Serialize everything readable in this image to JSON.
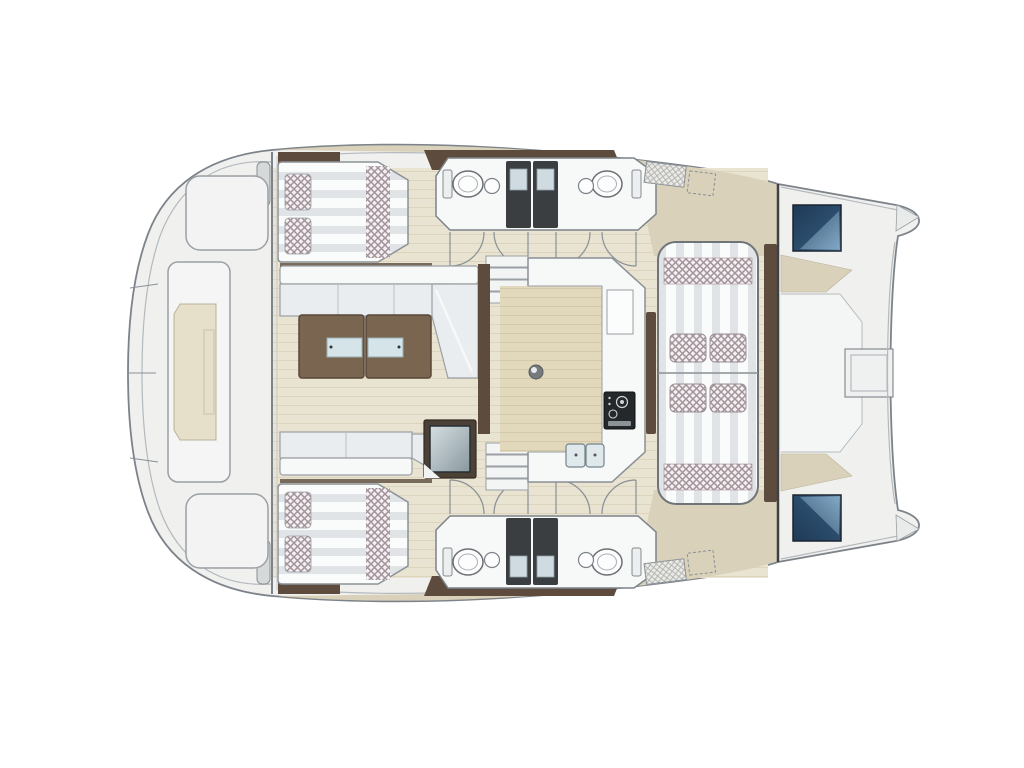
{
  "plan": {
    "vessel_type": "catamaran deck floor plan",
    "view": "top-down",
    "orientation": "bow right, stern left",
    "legend": [
      "aft swim platform with tender panel",
      "aft deck benches (2)",
      "aft cabin double berths with pillows (2)",
      "bathroom pods: toilet, washbasin, shower stalls (2 per hull)",
      "cabin door swings (8)",
      "companionway stairs (2)",
      "salon L-shaped sofa and aft sofa",
      "twin wooden coffee tables with glass inserts",
      "cooler cabinet",
      "U-shaped galley with stove, counter hatch and double sink",
      "floor pedestal fitting",
      "forward cockpit facing loungers with cushions (4 seat pads)",
      "bow deck hatches tinted blue (2)",
      "central foredeck hatch",
      "gunwale step pads (2)"
    ]
  },
  "colors": {
    "background": "#ffffff",
    "deck_white": "#f0f1ef",
    "side_deck": "#d9d1ba",
    "floor_plank": "#e9e3d1",
    "floor_line": "#dcd4bd",
    "galley_floor": "#e2d9bd",
    "galley_floor_line": "#d3c9a9",
    "furniture_white": "#f7f9f9",
    "cushion_gray": "#e9edef",
    "stripe_light": "#fafbfb",
    "stripe_dark": "#e0e4e7",
    "wood_dark": "#5d4c3d",
    "wood_table": "#7a6550",
    "glass_blue": "#d4e4e8",
    "check_base": "#f4f0f1",
    "check_line": "#a2939b",
    "shower_dark": "#3a3e41",
    "shower_tray": "#cfdbe0",
    "hatch_blue_dark": "#1e3a55",
    "hatch_blue_light": "#7ba3c2",
    "stove_dark": "#24282b",
    "sink_basin": "#dfe9ec",
    "outline_gray": "#7d838a",
    "outline_light": "#b4b9bd",
    "platform_beige": "#e6dfca"
  }
}
